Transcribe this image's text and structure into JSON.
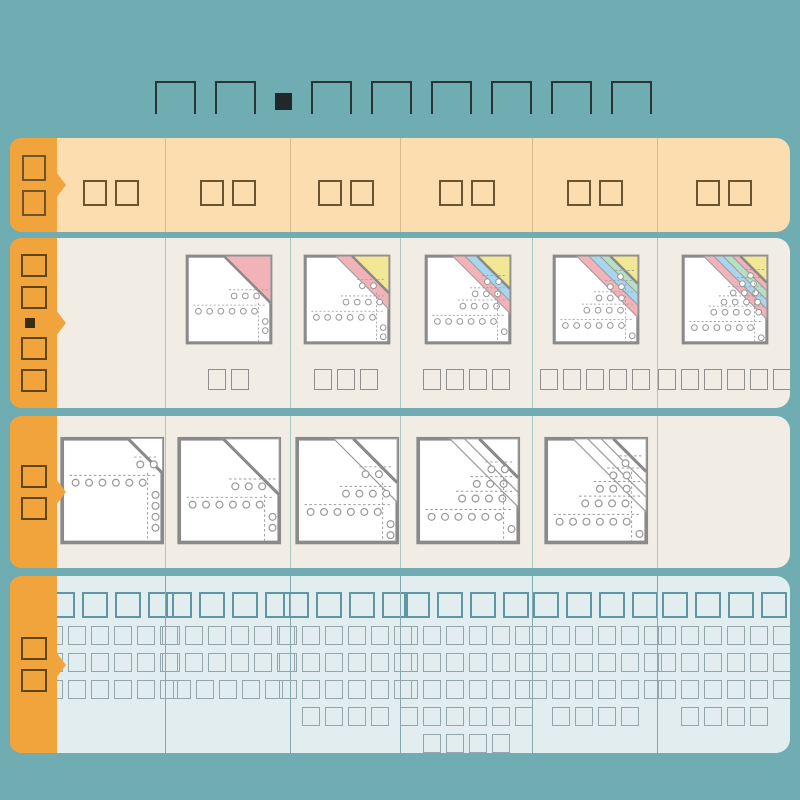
{
  "page": {
    "background": "#6FADB2",
    "accent_orange": "#F2A43C",
    "header_row_bg": "#FBDDAF",
    "paper_row_bg": "#F1EDE5",
    "usage_row_bg": "#E2EDF0"
  },
  "title": {
    "glyphs": "□□■□□□□□□"
  },
  "paper_colors": {
    "white": "#FFFFFF",
    "pink": "#F2B3B8",
    "blue": "#A9D6EF",
    "green": "#B7DFC6",
    "yellow": "#F2E795",
    "outline": "#8A8A8A"
  },
  "ply_palettes": {
    "2": [
      "pink"
    ],
    "3": [
      "pink",
      "yellow"
    ],
    "4": [
      "pink",
      "blue",
      "yellow"
    ],
    "5": [
      "pink",
      "blue",
      "green",
      "yellow"
    ],
    "6": [
      "pink",
      "blue",
      "green",
      "pink",
      "yellow"
    ]
  },
  "table": {
    "header": {
      "tab": "□□",
      "cells": [
        "□□",
        "□□",
        "□□",
        "□□",
        "□□",
        "□□"
      ]
    },
    "ply_row": {
      "tab": "□□■□□",
      "cells": [
        {
          "plies": 0,
          "label": ""
        },
        {
          "plies": 2,
          "label": "□□"
        },
        {
          "plies": 3,
          "label": "□□□"
        },
        {
          "plies": 4,
          "label": "□□□□"
        },
        {
          "plies": 5,
          "label": "□□□□□"
        },
        {
          "plies": 6,
          "label": "□□□□□□"
        }
      ]
    },
    "white_row": {
      "tab": "□□",
      "cells": [
        {
          "plies": 1
        },
        {
          "plies": 2
        },
        {
          "plies": 3
        },
        {
          "plies": 4
        },
        {
          "plies": 5
        },
        {
          "plies": 0
        }
      ]
    },
    "usage_row": {
      "tab": "□□",
      "cells": [
        {
          "heading": "□□□□",
          "lines": [
            "□□□□□□",
            "□□□□□□",
            "□□□□□□"
          ]
        },
        {
          "heading": "□□□□",
          "lines": [
            "□□□□□□",
            "□□□□□□",
            "□□□□□"
          ]
        },
        {
          "heading": "□□□□",
          "lines": [
            "□□□□□□",
            "□□□□□□",
            "□□□□□□",
            "□□□□"
          ]
        },
        {
          "heading": "□□□□",
          "lines": [
            "□□□□□□",
            "□□□□□□",
            "□□□□□□",
            "□□□□□□",
            "□□□□"
          ]
        },
        {
          "heading": "□□□□",
          "lines": [
            "□□□□□□",
            "□□□□□□",
            "□□□□□□",
            "□□□□"
          ]
        },
        {
          "heading": "□□□□",
          "lines": [
            "□□□□□□",
            "□□□□□□",
            "□□□□□□",
            "□□□□"
          ]
        }
      ]
    }
  }
}
